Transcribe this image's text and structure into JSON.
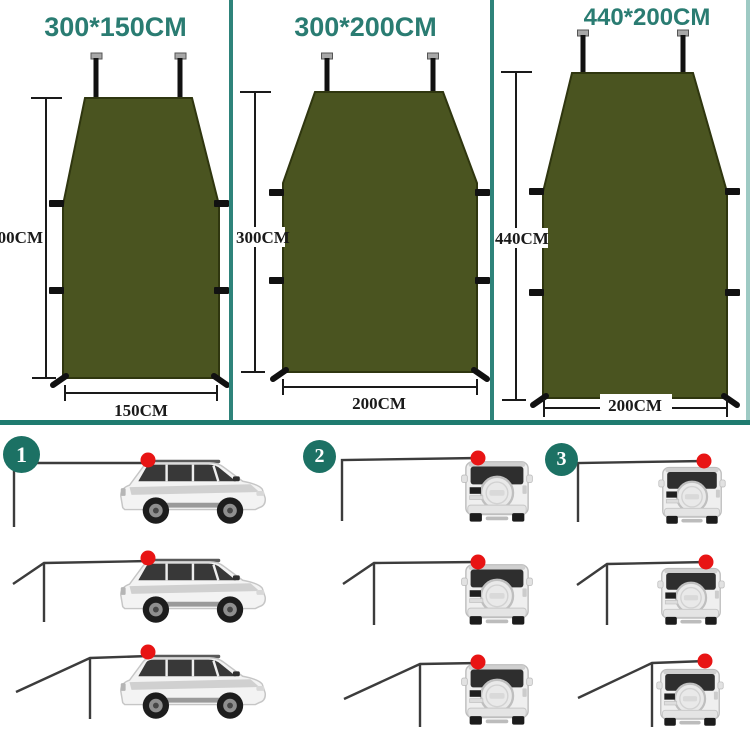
{
  "section_sizes": {
    "panels": [
      {
        "title": "300*150CM",
        "height_label": "300CM",
        "width_label": "150CM"
      },
      {
        "title": "300*200CM",
        "height_label": "300CM",
        "width_label": "200CM"
      },
      {
        "title": "440*200CM",
        "height_label": "440CM",
        "width_label": "200CM"
      }
    ]
  },
  "section_setups": {
    "steps": [
      {
        "number": "1"
      },
      {
        "number": "2"
      },
      {
        "number": "3"
      }
    ]
  },
  "colors": {
    "title_teal": "#2a7c72",
    "badge_teal": "#1c7164",
    "divider_teal": "#1f7b70",
    "border_light_teal": "#9ecac4",
    "tarp_olive": "#4a5420",
    "tarp_outline": "#2f360f",
    "attachment_red": "#e81414",
    "line_dark": "#3c3c3c"
  }
}
